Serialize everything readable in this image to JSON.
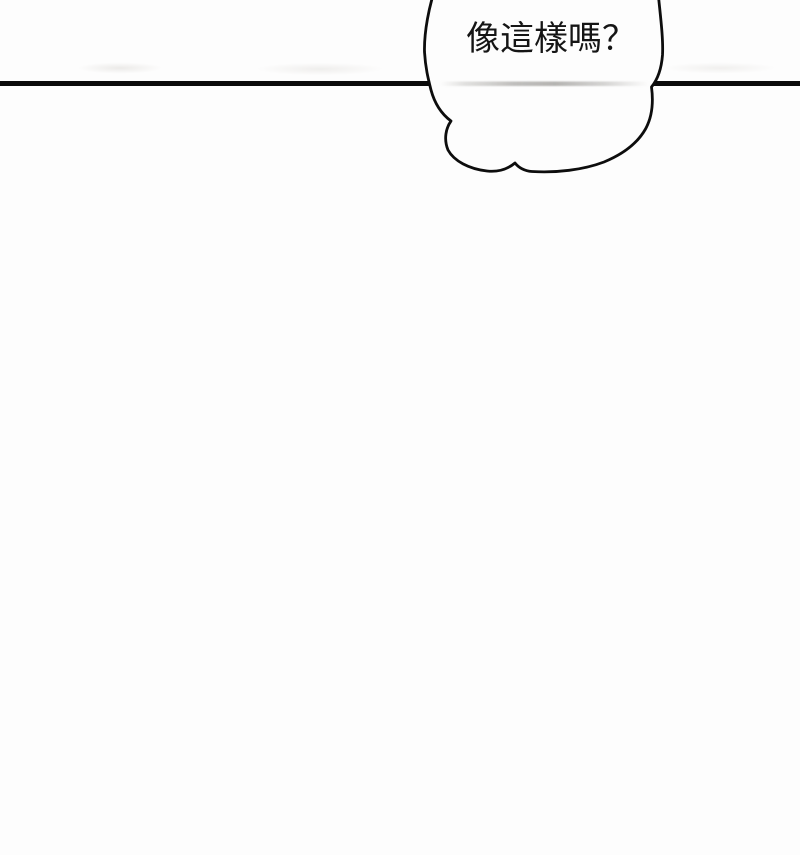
{
  "page": {
    "background_color": "#fdfdfd",
    "ink_color": "#0d0d0d"
  },
  "speech_bubble": {
    "text": "像這樣嗎？",
    "fill_color": "#fdfdfd",
    "outline_color": "#0d0d0d",
    "residue_color": "#8a8884"
  }
}
